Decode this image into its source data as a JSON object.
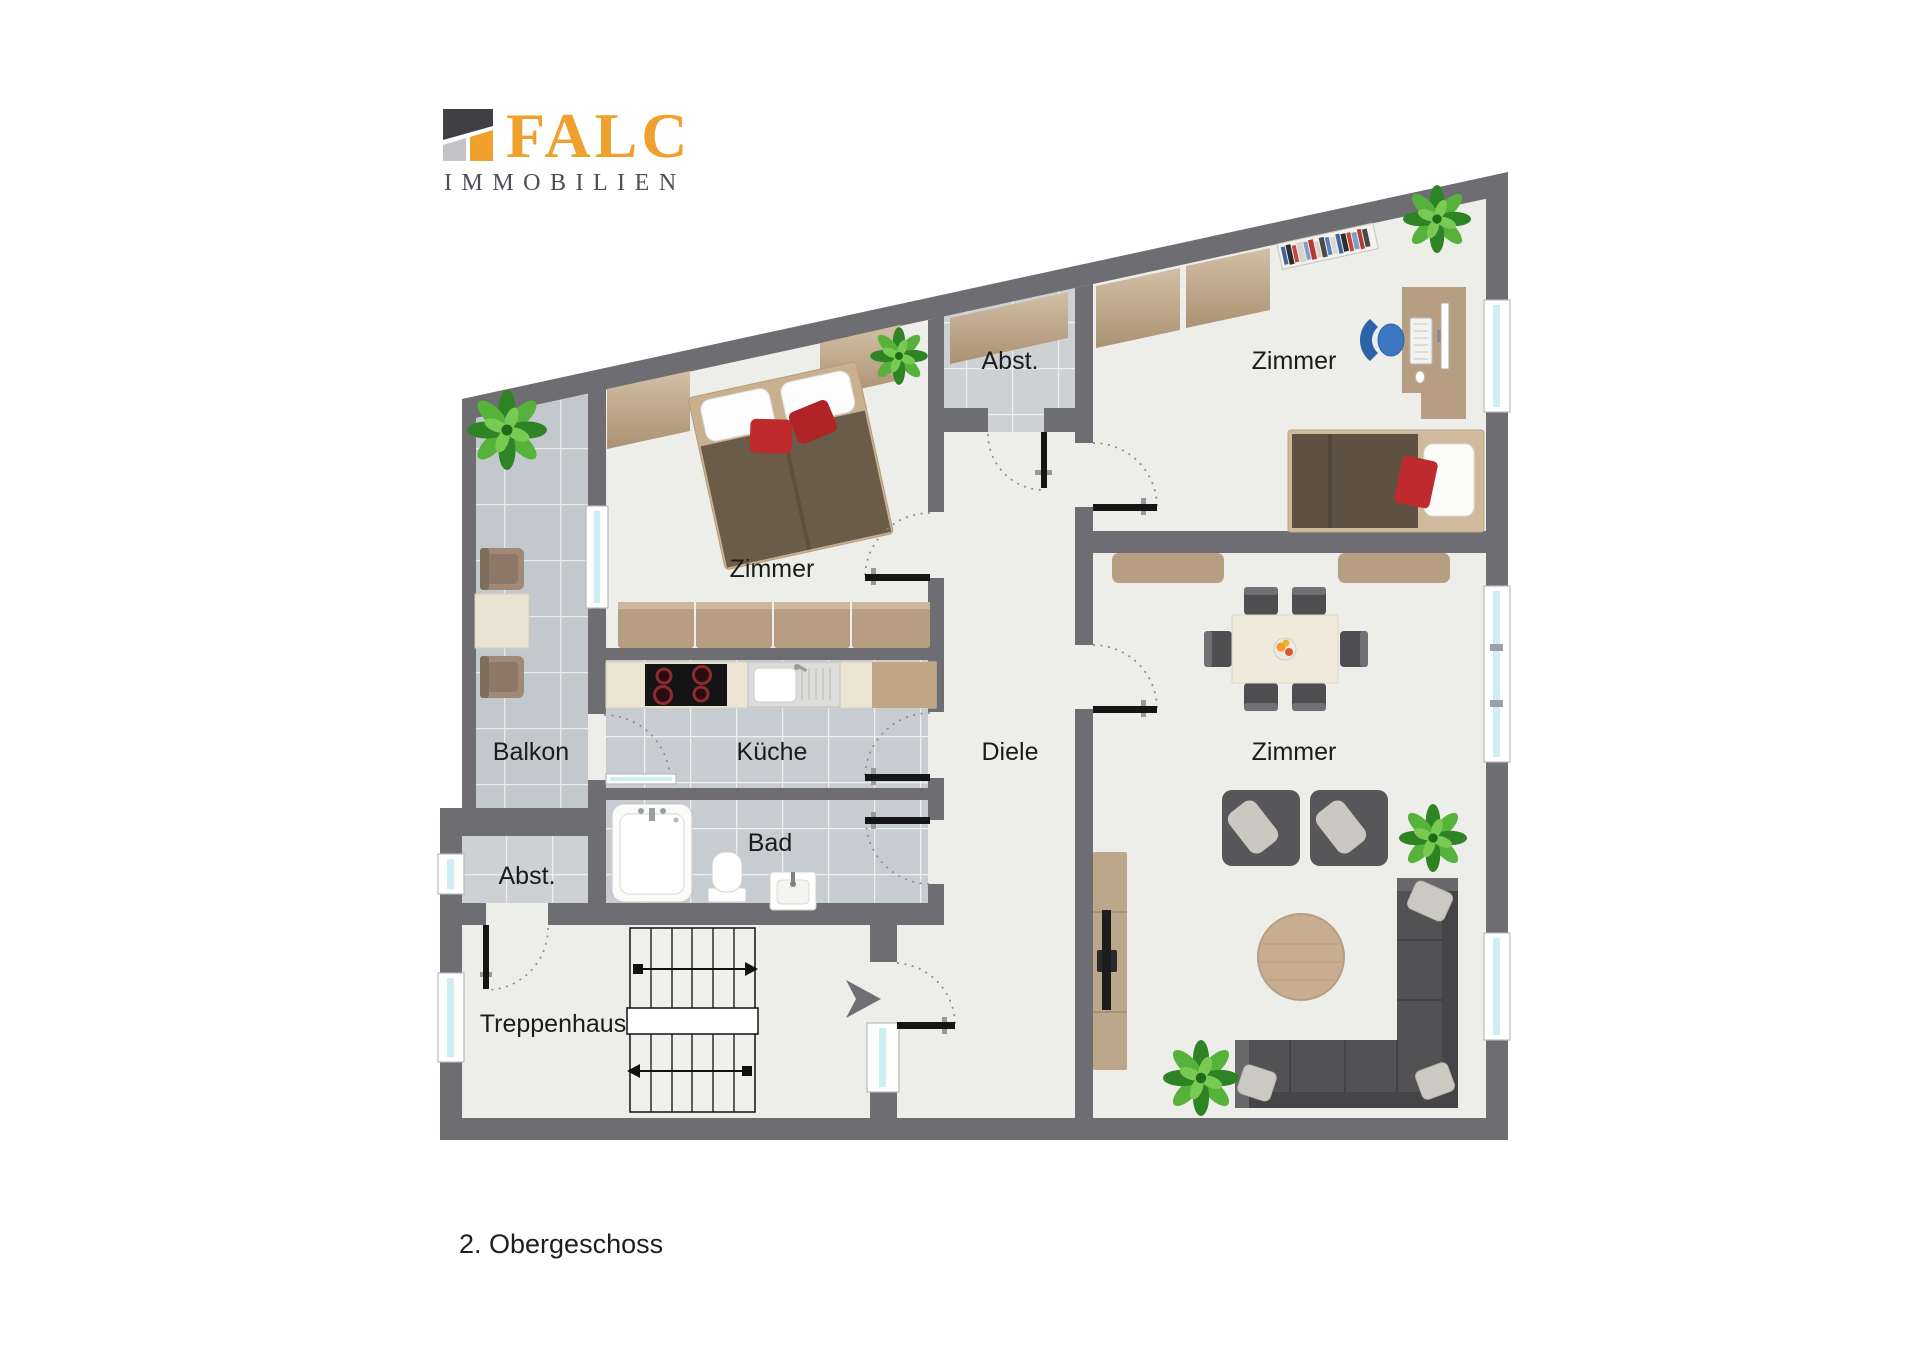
{
  "brand": {
    "name": "FALC",
    "subtitle": "IMMOBILIEN",
    "orange": "#f0a02c",
    "dark_mark": "#3f3f44",
    "gray_mark": "#c4c4c6"
  },
  "caption": "2. Obergeschoss",
  "rooms": {
    "balkon": {
      "label": "Balkon"
    },
    "zimmer_nw": {
      "label": "Zimmer"
    },
    "abst_top": {
      "label": "Abst."
    },
    "zimmer_ne": {
      "label": "Zimmer"
    },
    "kueche": {
      "label": "Küche"
    },
    "diele": {
      "label": "Diele"
    },
    "zimmer_e": {
      "label": "Zimmer"
    },
    "bad": {
      "label": "Bad"
    },
    "abst_sw": {
      "label": "Abst."
    },
    "treppenhaus": {
      "label": "Treppenhaus"
    }
  },
  "palette": {
    "wall": "#6e6e72",
    "floor": "#edeee9",
    "tile": "#c7ccd0",
    "balcony_tile": "#c2c8cc",
    "window_glass": "#cdeef2",
    "wood": "#b79e83",
    "counter": "#ebe4d2",
    "sofa": "#525255",
    "bed_nw_duvet": "#6b5b49",
    "bed_ne_duvet": "#5e5142",
    "cushion_red": "#bf2a2e",
    "plant_green": "#2e8424"
  }
}
